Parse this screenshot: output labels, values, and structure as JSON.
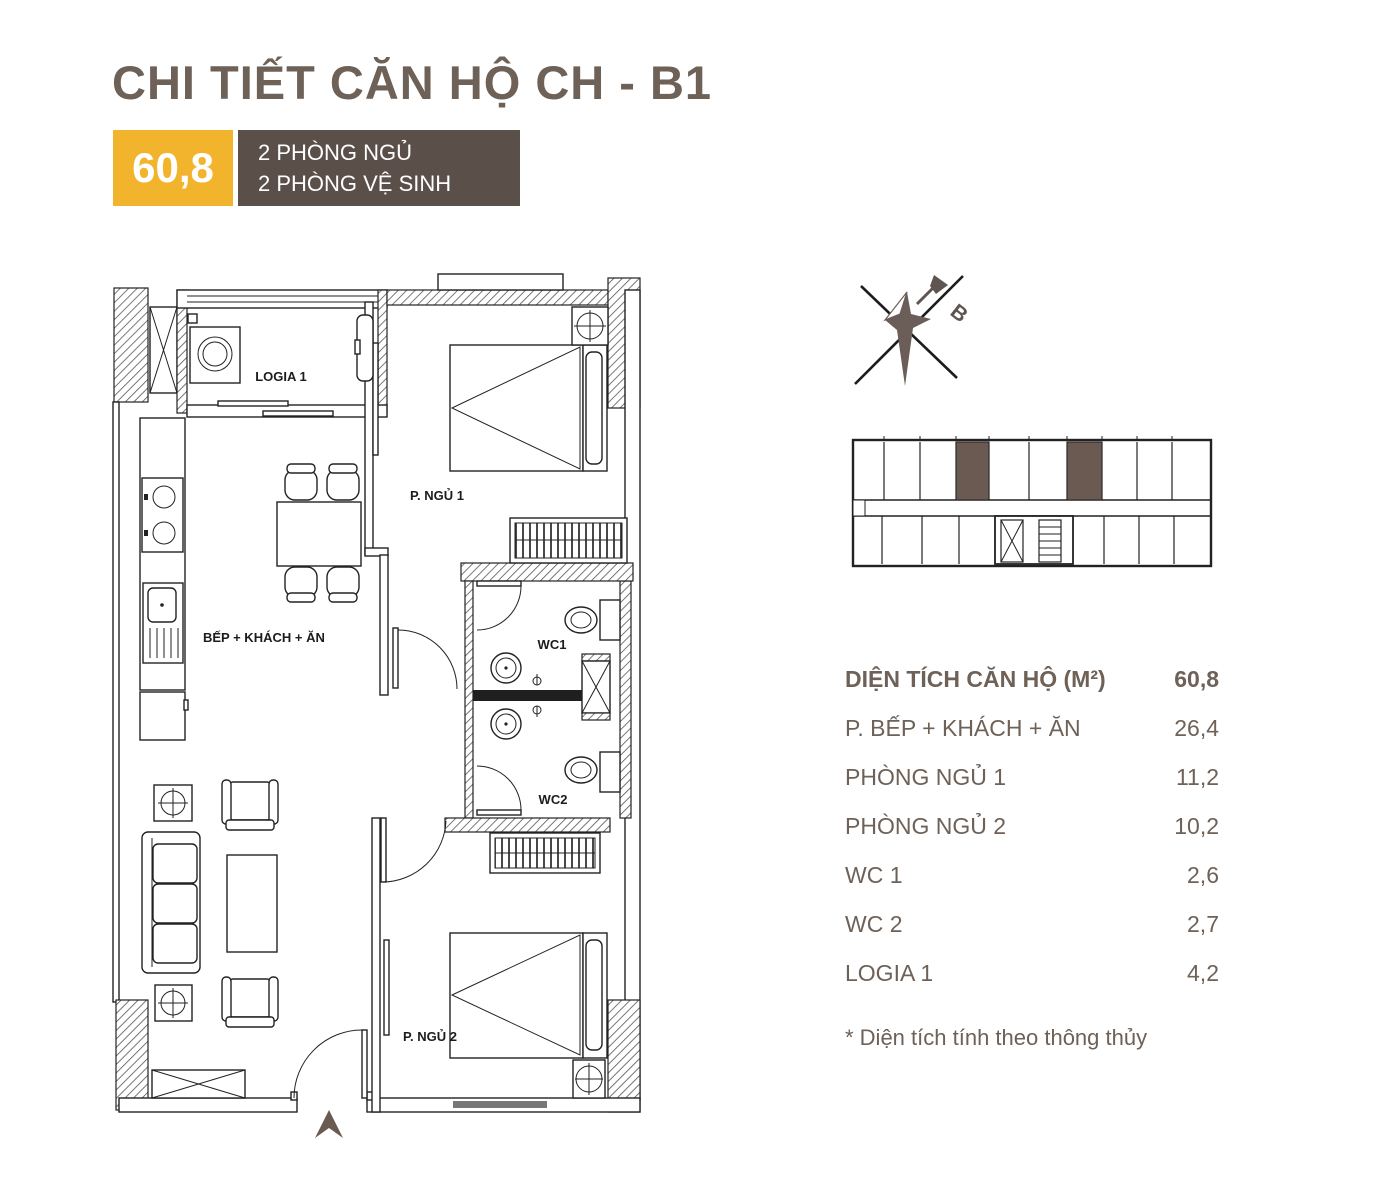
{
  "header": {
    "title": "CHI TIẾT CĂN HỘ CH - B1",
    "area_badge": "60,8",
    "badge_color": "#F2B42D",
    "info_box_color": "#5A4F49",
    "info_line_1": "2 PHÒNG NGỦ",
    "info_line_2": "2 PHÒNG VỆ SINH"
  },
  "floor_plan": {
    "labels": {
      "logia": "LOGIA 1",
      "bedroom1": "P. NGỦ 1",
      "kitchen_living": "BẾP + KHÁCH + ĂN",
      "wc1": "WC1",
      "wc2": "WC2",
      "bedroom2": "P. NGỦ 2"
    },
    "entry_arrow_color": "#6B5A52"
  },
  "compass": {
    "north_label": "B",
    "star_color": "#6B5D57"
  },
  "key_plan": {
    "highlight_color": "#6B5A52"
  },
  "area_table": {
    "text_color": "#6E6157",
    "header": {
      "label": "DIỆN TÍCH CĂN HỘ (M²)",
      "value": "60,8"
    },
    "rows": [
      {
        "label": "P. BẾP + KHÁCH + ĂN",
        "value": "26,4"
      },
      {
        "label": "PHÒNG NGỦ 1",
        "value": "11,2"
      },
      {
        "label": "PHÒNG NGỦ 2",
        "value": "10,2"
      },
      {
        "label": "WC 1",
        "value": "2,6"
      },
      {
        "label": "WC 2",
        "value": "2,7"
      },
      {
        "label": "LOGIA 1",
        "value": "4,2"
      }
    ],
    "footnote": "* Diện tích tính theo thông thủy"
  }
}
